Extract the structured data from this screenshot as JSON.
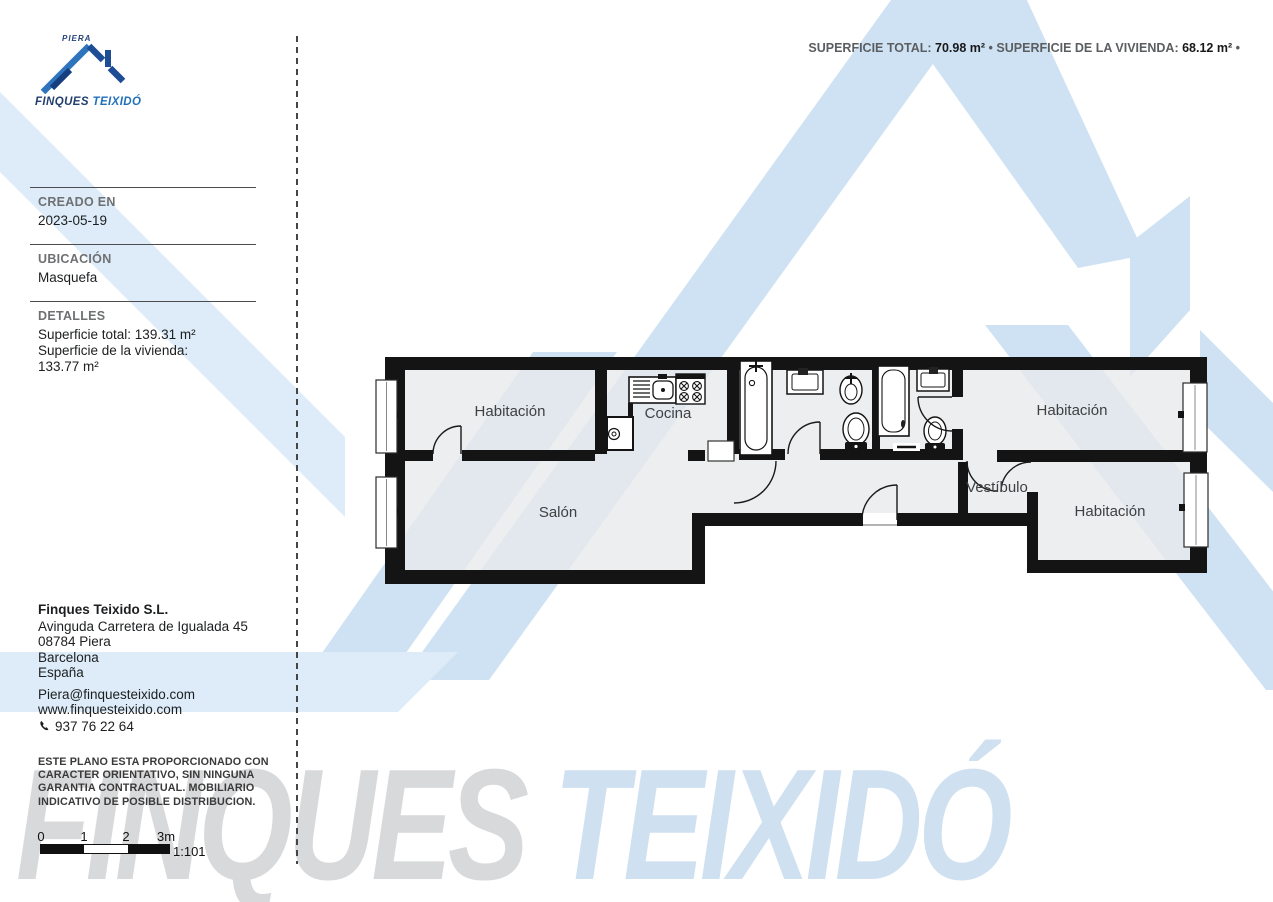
{
  "header": {
    "logo": {
      "city": "PIERA",
      "brand_primary": "FINQUES",
      "brand_secondary": "TEIXIDÓ"
    },
    "surface": {
      "total_label": "SUPERFICIE TOTAL:",
      "total_value": "70.98 m²",
      "separator": "•",
      "dwelling_label": "SUPERFICIE DE LA VIVIENDA:",
      "dwelling_value": "68.12 m²",
      "trailing": "•"
    }
  },
  "sidebar": {
    "sections": [
      {
        "heading": "CREADO EN",
        "lines": [
          "2023-05-19"
        ]
      },
      {
        "heading": "UBICACIÓN",
        "lines": [
          "Masquefa"
        ]
      },
      {
        "heading": "DETALLES",
        "lines": [
          "Superficie total: 139.31 m²",
          "Superficie de la vivienda:",
          "133.77 m²"
        ]
      }
    ],
    "company": {
      "name": "Finques Teixido S.L.",
      "address1": "Avinguda Carretera de Igualada 45",
      "address2": "08784 Piera",
      "address3": "Barcelona",
      "address4": "España",
      "email": "Piera@finquesteixido.com",
      "website": "www.finquesteixido.com",
      "phone": "937 76 22 64"
    },
    "disclaimer": {
      "line1": "ESTE PLANO ESTA PROPORCIONADO CON",
      "line2": "CARACTER ORIENTATIVO, SIN NINGUNA",
      "line3": "GARANTIA CONTRACTUAL. MOBILIARIO",
      "line4": "INDICATIVO DE POSIBLE DISTRIBUCION."
    },
    "scalebar": {
      "t0": "0",
      "t1": "1",
      "t2": "2",
      "t3": "3m",
      "ratio": "1:101"
    }
  },
  "plan": {
    "rooms": [
      {
        "label": "Habitación"
      },
      {
        "label": "Cocina"
      },
      {
        "label": "Habitación"
      },
      {
        "label": "Salón"
      },
      {
        "label": "Vestíbulo"
      },
      {
        "label": "Habitación"
      }
    ]
  },
  "watermark": {
    "word1": "FINQUES",
    "word2": "TEIXIDÓ"
  },
  "colors": {
    "logo_navy": "#223f6e",
    "logo_blue": "#2170bb",
    "watermark_blue": "#cfe2f3",
    "watermark_blue_light": "#ddecf8",
    "watermark_gray": "#d8d9db",
    "wall_black": "#141414",
    "floor_gray": "#e8e9ea"
  }
}
